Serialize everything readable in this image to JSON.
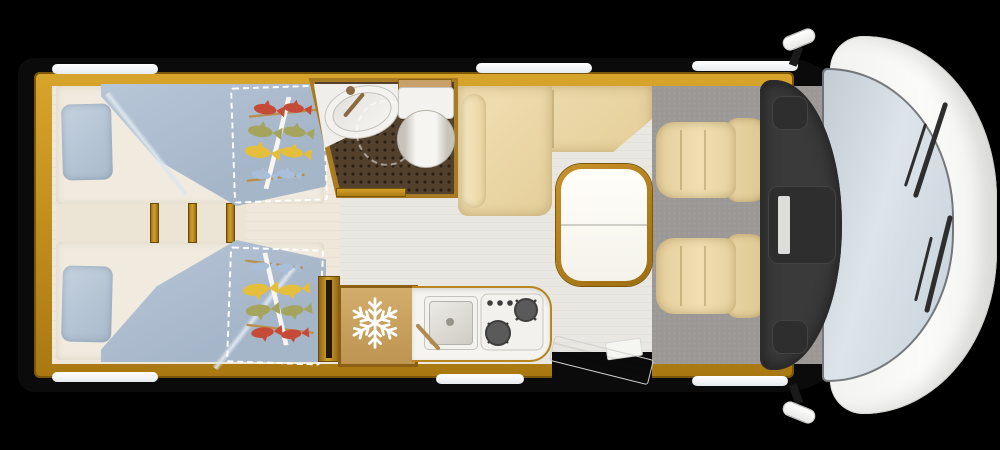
{
  "meta": {
    "title": "Motorhome floor plan - top view",
    "view": "overhead"
  },
  "legend": {
    "vehicle": "Motorhome floor plan viewed from above",
    "bedroom": "Rear bedroom with twin single beds",
    "bed": "Single bed with blue duvet and pillow",
    "bed_extension": "Fold-out bed section with dashed outline and fish-print cover",
    "bathroom": "Washroom with corner sink, shower tray and toilet",
    "wardrobe": "Wardrobe cabinet",
    "kitchen": "Kitchenette with refrigerator, sink and two-burner hob",
    "fridge": "Refrigerator",
    "dinette": "L-shaped lounge bench",
    "table": "Folding dinette table",
    "cab": "Driver cab with two swivel captain seats",
    "driver_seat": "Driver seat",
    "passenger_seat": "Passenger seat",
    "dashboard": "Dashboard",
    "windshield": "Windscreen with wipers",
    "entry_door": "Entry door shown open",
    "window": "Window",
    "mirror": "Side mirror",
    "step": "Entry step"
  },
  "icons": {
    "fridge": "snowflake-icon",
    "bed_decor": "fish-mobile-icon"
  },
  "colors": {
    "background": "#000000",
    "body_shell": "#0b0b0b",
    "wood_trim": "#b9861c",
    "wood_trim_dark": "#7a5608",
    "bedroom_floor": "#eee7da",
    "living_floor": "#e9e7e2",
    "cab_carpet": "#9c9895",
    "mattress": "#f1ebdf",
    "bedding_blue": "#b2c2d4",
    "upholstery_beige": "#e9d6a4",
    "bathroom_floor": "#53412e",
    "fixture_white": "#f3f2ee",
    "dashboard_gray": "#3a3a3a",
    "windshield_glass": "#cfd9e1",
    "vehicle_white": "#fafafa",
    "fish_red": "#c64a38",
    "fish_olive": "#a5a45e",
    "fish_yellow": "#e5be3c",
    "fish_blue": "#a9bed8"
  }
}
